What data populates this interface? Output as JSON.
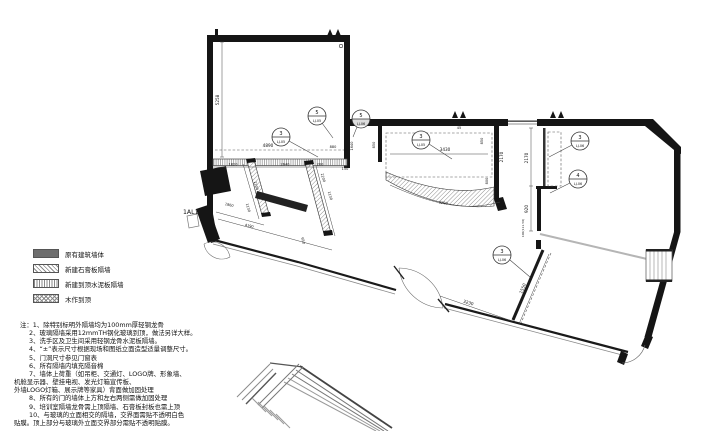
{
  "legend": {
    "items": [
      {
        "swatch": "existing-wall-solid",
        "label": "原有建筑墙体"
      },
      {
        "swatch": "new-gypsum-partition-diagonal-hatch",
        "label": "新建石膏板隔墙"
      },
      {
        "swatch": "new-cement-board-partition-line-hatch",
        "label": "新建到顶水泥板隔墙"
      },
      {
        "swatch": "woodwork-to-ceiling-cross-hatch",
        "label": "木作到顶"
      }
    ]
  },
  "notes": {
    "prefix": "注：",
    "lines": [
      "1、除特别标明外隔墙均为100mm厚轻钢龙骨",
      "2、玻璃隔墙采用12mmTH钢化玻璃到顶，做法另详大样。",
      "3、洗手区及卫生间采用轻钢龙骨水泥板隔墙。",
      "4、“±”表示尺寸根据现场和图纸立面造型适量调整尺寸。",
      "5、门洞尺寸参见门窗表",
      "6、所有隔墙内填充隔音棉",
      "7、墙体上荷重（如吊柜、交通灯、LOGO牌、形象墙、",
      "机舱显示器、壁挂电视、发光灯箱宣传板、",
      "外墙LOGO灯箱、展示牌等家具）背面做加固处理",
      "8、所有的门的墙体上方和左右两侧需做加固处理",
      "9、培训室隔墙龙骨需上顶隔墙、石膏板封板也需上顶",
      "10、与玻璃的立面相交的隔墙，交界面需贴不透明白色",
      "贴膜。顶上部分与玻璃外立面交界部分需贴不透明贴膜。"
    ]
  },
  "plan": {
    "label_1al1": "1AL1",
    "dims": [
      "5258",
      "4890",
      "1820",
      "2640",
      "400",
      "200",
      "150",
      "880",
      "1640",
      "850",
      "3430",
      "45",
      "850",
      "2170",
      "800",
      "3200",
      "2170",
      "920",
      "100(111.50)",
      "3230",
      "1550",
      "2200",
      "1130",
      "650",
      "1860",
      "4190",
      "1130",
      "2200"
    ],
    "callouts": [
      {
        "num": "3",
        "ref": "LJ-05"
      },
      {
        "num": "5",
        "ref": "LJ-05"
      },
      {
        "num": "5",
        "ref": "LJ-06"
      },
      {
        "num": "3",
        "ref": "LJ-05"
      },
      {
        "num": "3",
        "ref": "LJ-06"
      },
      {
        "num": "4",
        "ref": "LJ-06"
      },
      {
        "num": "3",
        "ref": "LJ-06"
      }
    ]
  }
}
